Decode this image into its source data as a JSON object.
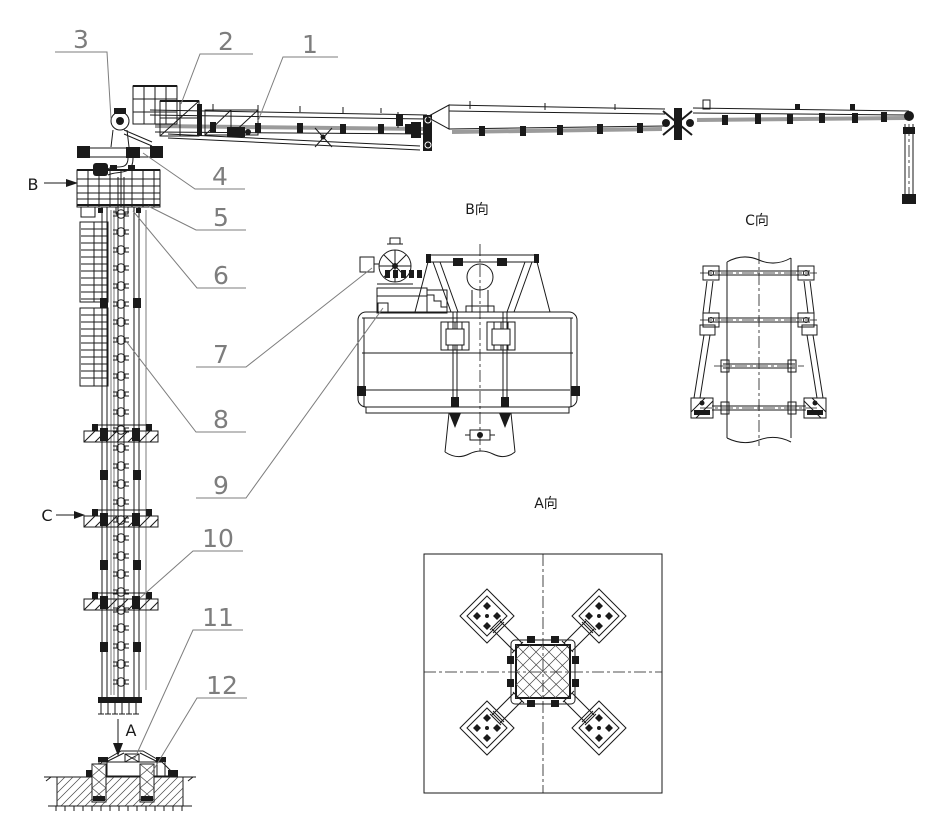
{
  "parts": [
    "1",
    "2",
    "3",
    "4",
    "5",
    "6",
    "7",
    "8",
    "9",
    "10",
    "11",
    "12"
  ],
  "views": {
    "b": "B向",
    "c": "C向",
    "a": "A向"
  },
  "sections": {
    "b": "B",
    "c": "C",
    "a": "A"
  },
  "colors": {
    "ink": "#1a1a1a",
    "label": "#7d7d7d",
    "pipe": "#9b9b9b",
    "background": "#ffffff"
  }
}
